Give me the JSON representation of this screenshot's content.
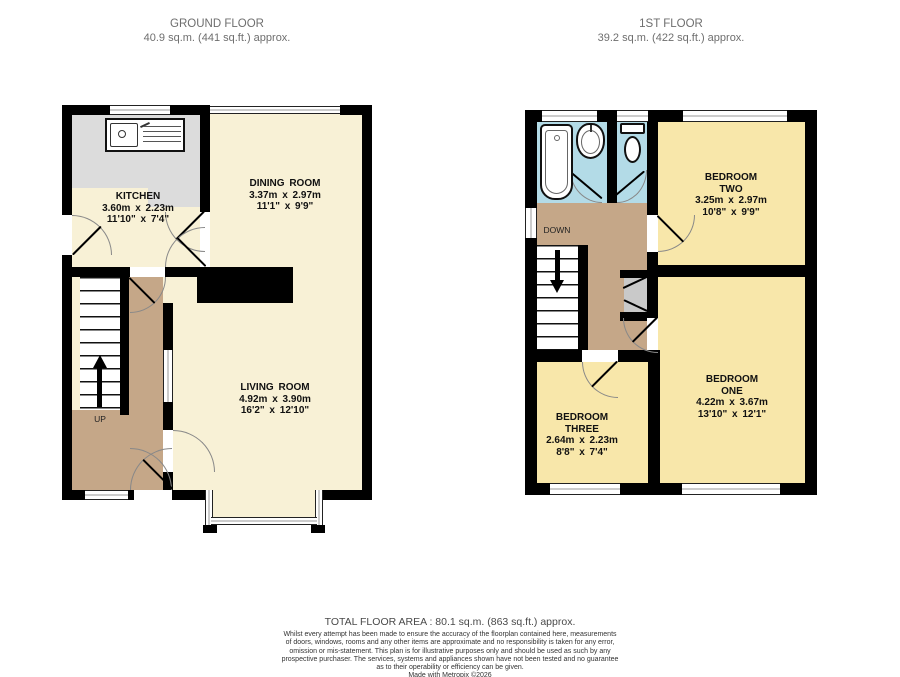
{
  "colors": {
    "wall": "#000000",
    "cream": "#f8f1d6",
    "yellow": "#f8e7aa",
    "tan": "#c5a788",
    "floorgray": "#dcdcdc",
    "blue": "#b3dbe7",
    "hdr": "#6e6e6e",
    "lbl": "#111111",
    "arc": "#888888"
  },
  "ground_floor": {
    "title": "GROUND FLOOR",
    "area": "40.9 sq.m. (441 sq.ft.) approx.",
    "stairs_label": "UP",
    "rooms": {
      "kitchen": {
        "name": "KITCHEN",
        "metric": "3.60m x 2.23m",
        "imperial": "11'10\" x 7'4\""
      },
      "dining": {
        "name": "DINING ROOM",
        "metric": "3.37m x 2.97m",
        "imperial": "11'1\" x 9'9\""
      },
      "living": {
        "name": "LIVING ROOM",
        "metric": "4.92m x 3.90m",
        "imperial": "16'2\" x 12'10\""
      }
    }
  },
  "first_floor": {
    "title": "1ST FLOOR",
    "area": "39.2 sq.m. (422 sq.ft.) approx.",
    "stairs_label": "DOWN",
    "rooms": {
      "bedroom_two": {
        "name1": "BEDROOM",
        "name2": "TWO",
        "metric": "3.25m x 2.97m",
        "imperial": "10'8\" x 9'9\""
      },
      "bedroom_one": {
        "name1": "BEDROOM",
        "name2": "ONE",
        "metric": "4.22m x 3.67m",
        "imperial": "13'10\" x 12'1\""
      },
      "bedroom_three": {
        "name1": "BEDROOM",
        "name2": "THREE",
        "metric": "2.64m x 2.23m",
        "imperial": "8'8\" x 7'4\""
      }
    }
  },
  "footer": {
    "total": "TOTAL FLOOR AREA : 80.1 sq.m. (863 sq.ft.) approx.",
    "disclaimer": [
      "Whilst every attempt has been made to ensure the accuracy of the floorplan contained here, measurements",
      "of doors, windows, rooms and any other items are approximate and no responsibility is taken for any error,",
      "omission or mis-statement. This plan is for illustrative purposes only and should be used as such by any",
      "prospective purchaser. The services, systems and appliances shown have not been tested and no guarantee",
      "as to their operability or efficiency can be given."
    ],
    "credit": "Made with Metropix ©2026"
  }
}
